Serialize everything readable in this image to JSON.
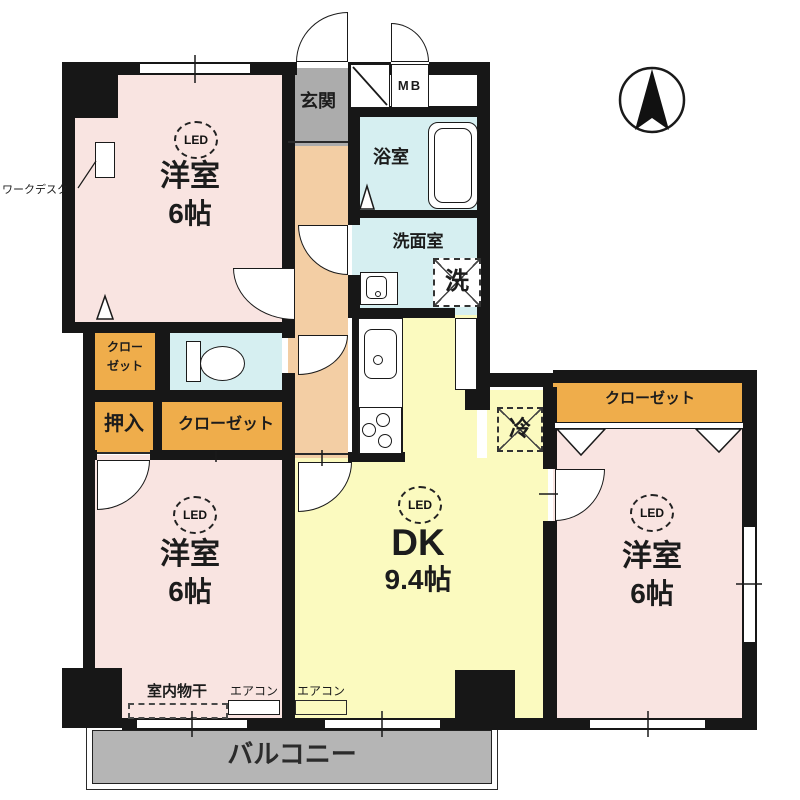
{
  "compass": {
    "direction": "north",
    "style": "arrow-in-circle"
  },
  "rooms": {
    "bedroom_top_left": {
      "light": "LED",
      "name": "洋室",
      "size": "6帖"
    },
    "bedroom_bottom_left": {
      "light": "LED",
      "name": "洋室",
      "size": "6帖"
    },
    "bedroom_right": {
      "light": "LED",
      "name": "洋室",
      "size": "6帖"
    },
    "dining_kitchen": {
      "light": "LED",
      "name": "DK",
      "size": "9.4帖"
    },
    "entrance": "玄関",
    "bathroom": "浴室",
    "washroom": "洗面室",
    "balcony": "バルコニー"
  },
  "storage": {
    "closet_upper": {
      "line1": "クロー",
      "line2": "ゼット"
    },
    "oshiire": "押入",
    "closet_lower": "クローゼット",
    "closet_right": "クローゼット"
  },
  "labels": {
    "meter_box": "MB",
    "washer": "洗",
    "fridge": "冷",
    "work_desk": "ワークデスク",
    "indoor_laundry": "室内物干",
    "aircon_left": "エアコン",
    "aircon_dk": "エアコン"
  },
  "colors": {
    "room_pink": "#f9e4e1",
    "dk_yellow": "#fbfabf",
    "wet_area_blue": "#d6eff1",
    "closet_orange": "#efad4b",
    "corridor_peach": "#f3cea4",
    "entrance_gray": "#acacac",
    "balcony_gray": "#b5b5b5",
    "wall_black": "#171717"
  }
}
